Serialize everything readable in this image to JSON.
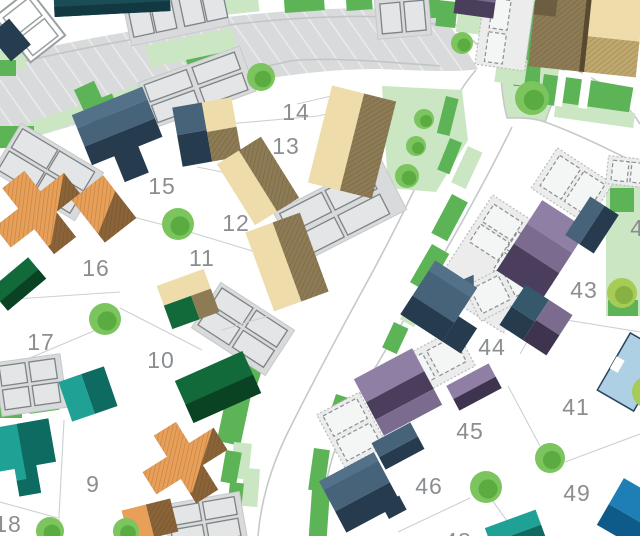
{
  "map": {
    "title": "residential development site plan",
    "style": "hand-drawn masterplan with coloured house roofs, roads, parking bays, hedges and trees",
    "plots": [
      {
        "number": "14",
        "x": 296,
        "y": 112
      },
      {
        "number": "13",
        "x": 286,
        "y": 146
      },
      {
        "number": "15",
        "x": 162,
        "y": 186
      },
      {
        "number": "12",
        "x": 236,
        "y": 223
      },
      {
        "number": "11",
        "x": 202,
        "y": 258
      },
      {
        "number": "16",
        "x": 96,
        "y": 268
      },
      {
        "number": "17",
        "x": 41,
        "y": 342
      },
      {
        "number": "10",
        "x": 161,
        "y": 360
      },
      {
        "number": "9",
        "x": 93,
        "y": 484
      },
      {
        "number": "18",
        "x": 8,
        "y": 524
      },
      {
        "number": "43",
        "x": 584,
        "y": 290
      },
      {
        "number": "44",
        "x": 492,
        "y": 347
      },
      {
        "number": "41",
        "x": 576,
        "y": 407
      },
      {
        "number": "45",
        "x": 470,
        "y": 431
      },
      {
        "number": "46",
        "x": 429,
        "y": 486
      },
      {
        "number": "49",
        "x": 577,
        "y": 493
      },
      {
        "number": "42",
        "x": 644,
        "y": 228,
        "partial": true
      },
      {
        "number": "48",
        "x": 458,
        "y": 541,
        "partial": true
      }
    ],
    "trees": [
      {
        "x": 261,
        "y": 77,
        "r": 14
      },
      {
        "x": 178,
        "y": 224,
        "r": 16
      },
      {
        "x": 105,
        "y": 319,
        "r": 16
      },
      {
        "x": 50,
        "y": 531,
        "r": 14
      },
      {
        "x": 126,
        "y": 531,
        "r": 13
      },
      {
        "x": 532,
        "y": 98,
        "r": 17
      },
      {
        "x": 462,
        "y": 43,
        "r": 11
      },
      {
        "x": 424,
        "y": 119,
        "r": 10
      },
      {
        "x": 416,
        "y": 146,
        "r": 10
      },
      {
        "x": 407,
        "y": 176,
        "r": 12
      },
      {
        "x": 550,
        "y": 458,
        "r": 15
      },
      {
        "x": 486,
        "y": 487,
        "r": 16
      },
      {
        "x": 622,
        "y": 293,
        "r": 15,
        "shade": "yellow"
      },
      {
        "x": 648,
        "y": 392,
        "r": 16,
        "shade": "yellow"
      }
    ],
    "palette": {
      "road": "#d8dadb",
      "roadline": "#c2c5c6",
      "outline": "#c6c9ca",
      "plotline": "#cdd0d1",
      "numgray": "#8a8e91",
      "lgreen": "#cbe6c2",
      "bgreen": "#5db457",
      "bgreen2": "#3f9445",
      "tree": "#7cc45e",
      "treedark": "#55a83c",
      "treeyellow": "#a6cb57",
      "treeyellowdark": "#7fae3c",
      "slate": "#47637a",
      "slateD": "#263c4e",
      "slateL": "#54718a",
      "slate2": "#35586b",
      "beige": "#eedcab",
      "khaki": "#8d7b55",
      "khaki2": "#bfa86e",
      "orange": "#e89f58",
      "orangeD": "#8a6338",
      "green1": "#12693a",
      "green2": "#0a4324",
      "teal": "#1fa295",
      "tealD": "#0e6b62",
      "purpleL": "#8f7fa5",
      "purpleM": "#7b6c8f",
      "purpleD": "#4a3e5c",
      "purpleDeep": "#3f3450",
      "lblue": "#aed0e4",
      "lblueEdge": "#27455e",
      "blue": "#1d7fb5",
      "blueD": "#0e5a88",
      "navy": "#263d4f",
      "tealRoof": "#1b4d57",
      "tealRoofD": "#123842",
      "stipple": "#ececec",
      "stippleEdge": "#b8bcbd",
      "bay": "#e3e5e6",
      "bayline": "#7e8486",
      "bayd": "#f4f5f5",
      "baydline": "#8a8f91",
      "sketch": "#9aa0a2"
    }
  }
}
